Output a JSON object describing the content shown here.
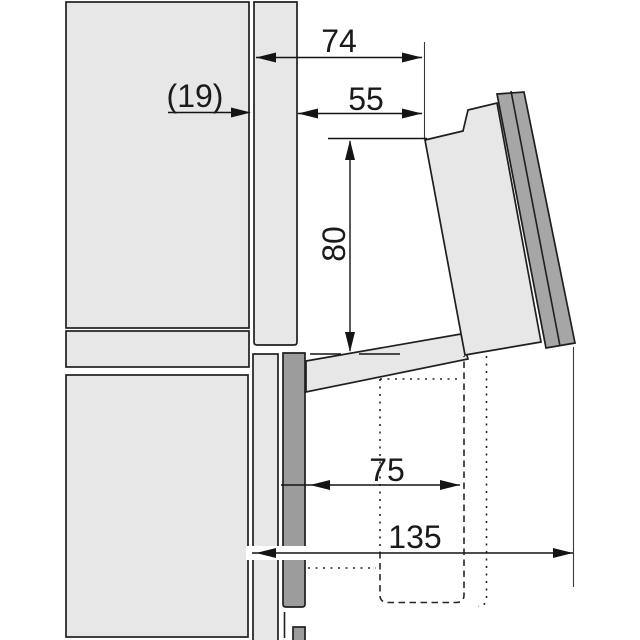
{
  "diagram": {
    "kind": "appliance-installation-side-section",
    "line_color": "#1f1f1f",
    "panel_fill": "#e7e7e7",
    "dark_panel_fill": "#9c9c9c",
    "labels": {
      "d74": "74",
      "d19": "(19)",
      "d55": "55",
      "d80": "80",
      "d75": "75",
      "d135": "135"
    }
  }
}
